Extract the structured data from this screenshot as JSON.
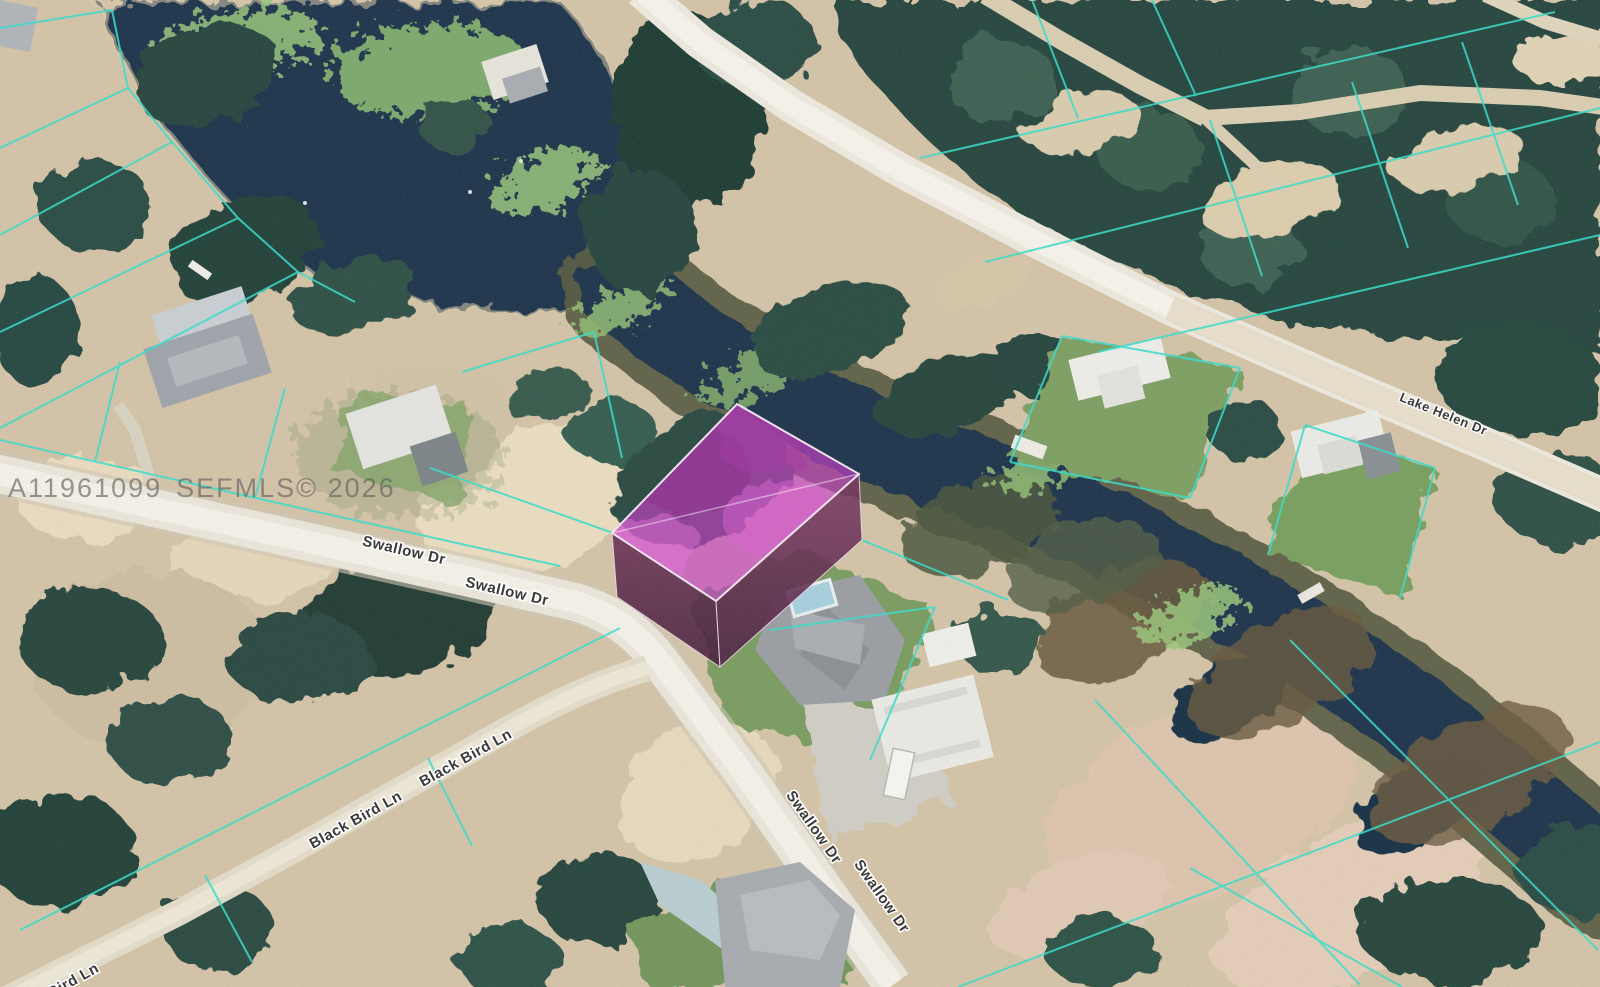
{
  "image": {
    "type": "aerial-parcel-map-photo",
    "watermark": [
      "A11961099",
      "SEFMLS© 2026"
    ],
    "street_labels": {
      "swallow_dr": "Swallow Dr",
      "black_bird_ln": "Black Bird Ln",
      "lake_helen_dr": "Lake Helen Dr"
    },
    "highlight": {
      "parcel_fill": "#c53fc5",
      "parcel_side_left_fill": "#552647",
      "parcel_side_right_fill": "#663053",
      "parcel_outline": "#f2e4f1"
    },
    "overlay": {
      "parcel_line_color": "#3bdccb"
    },
    "terrain": {
      "water_color": "#20394f",
      "sand_color": "#d3c3a8",
      "tree_color": "#2b4a42",
      "road_color": "#ece8dd"
    }
  }
}
